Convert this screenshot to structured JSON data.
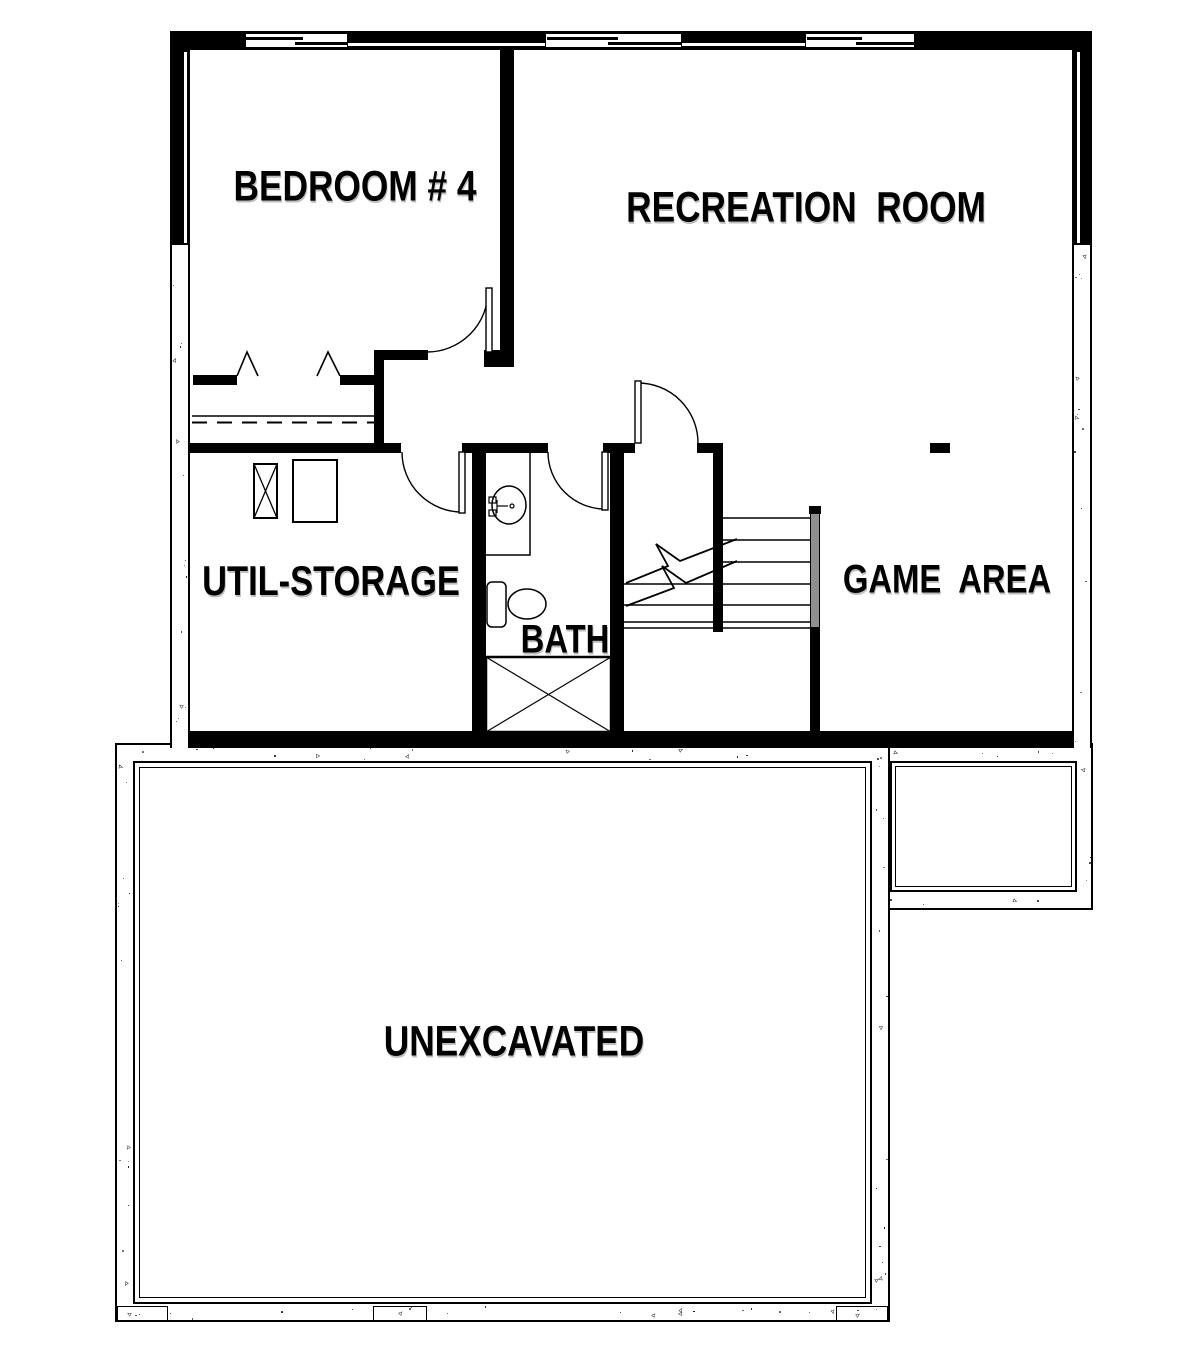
{
  "rooms": [
    {
      "id": "bedroom4",
      "label": "BEDROOM # 4"
    },
    {
      "id": "recreation",
      "label": "RECREATION  ROOM"
    },
    {
      "id": "util_storage",
      "label": "UTIL-STORAGE"
    },
    {
      "id": "bath",
      "label": "BATH"
    },
    {
      "id": "game_area",
      "label": "GAME  AREA"
    },
    {
      "id": "unexcavated",
      "label": "UNEXCAVATED"
    }
  ],
  "fixtures": {
    "washer": "washer-box-with-x",
    "dryer": "dryer-box",
    "sink": "oval-vanity-sink",
    "toilet": "toilet-tank-and-bowl",
    "shower": "shower-pan-with-x",
    "stairs": "stair-treads-with-break-lines",
    "handrail": "stair-handrail",
    "column": "support-post",
    "closet_doors": "bifold-door-peaks",
    "closet_shelf": "shelf-with-dashed-rod",
    "windows": [
      "sliding-window-1",
      "sliding-window-2",
      "sliding-window-3"
    ],
    "doors": [
      "bedroom-door",
      "util-storage-door",
      "bath-door",
      "stair-hall-door"
    ]
  },
  "colors": {
    "line": "#000000",
    "background": "#ffffff",
    "railing_fill": "#8f8f8f",
    "text_shadow": "#bdbdbd"
  }
}
